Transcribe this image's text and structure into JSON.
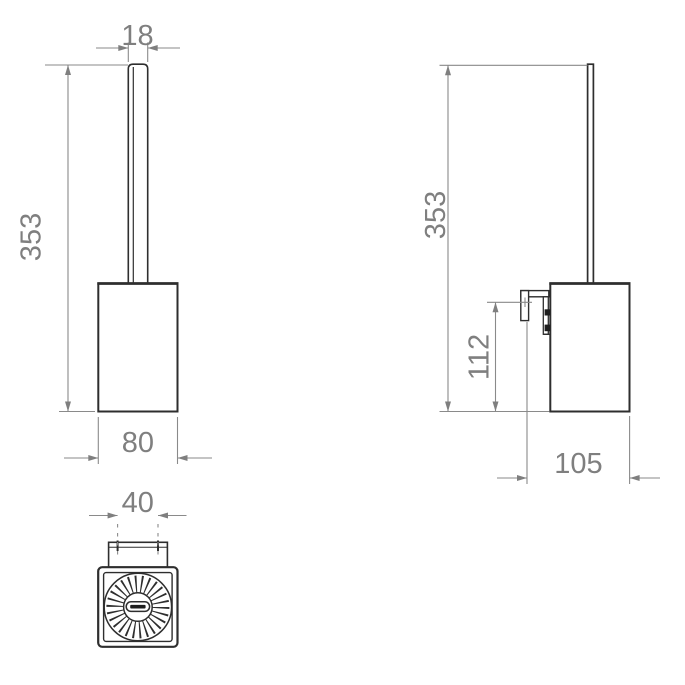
{
  "colors": {
    "background": "#ffffff",
    "object_line": "#2e2e2e",
    "dimension_line": "#8a8a8a",
    "dimension_text": "#7f7f7f"
  },
  "views": {
    "front": {
      "dims": {
        "handle_width": "18",
        "total_height": "353",
        "body_width": "80"
      }
    },
    "side": {
      "dims": {
        "total_height": "353",
        "bracket_height": "112",
        "depth": "105"
      }
    },
    "top": {
      "dims": {
        "plate_width": "40"
      }
    }
  }
}
